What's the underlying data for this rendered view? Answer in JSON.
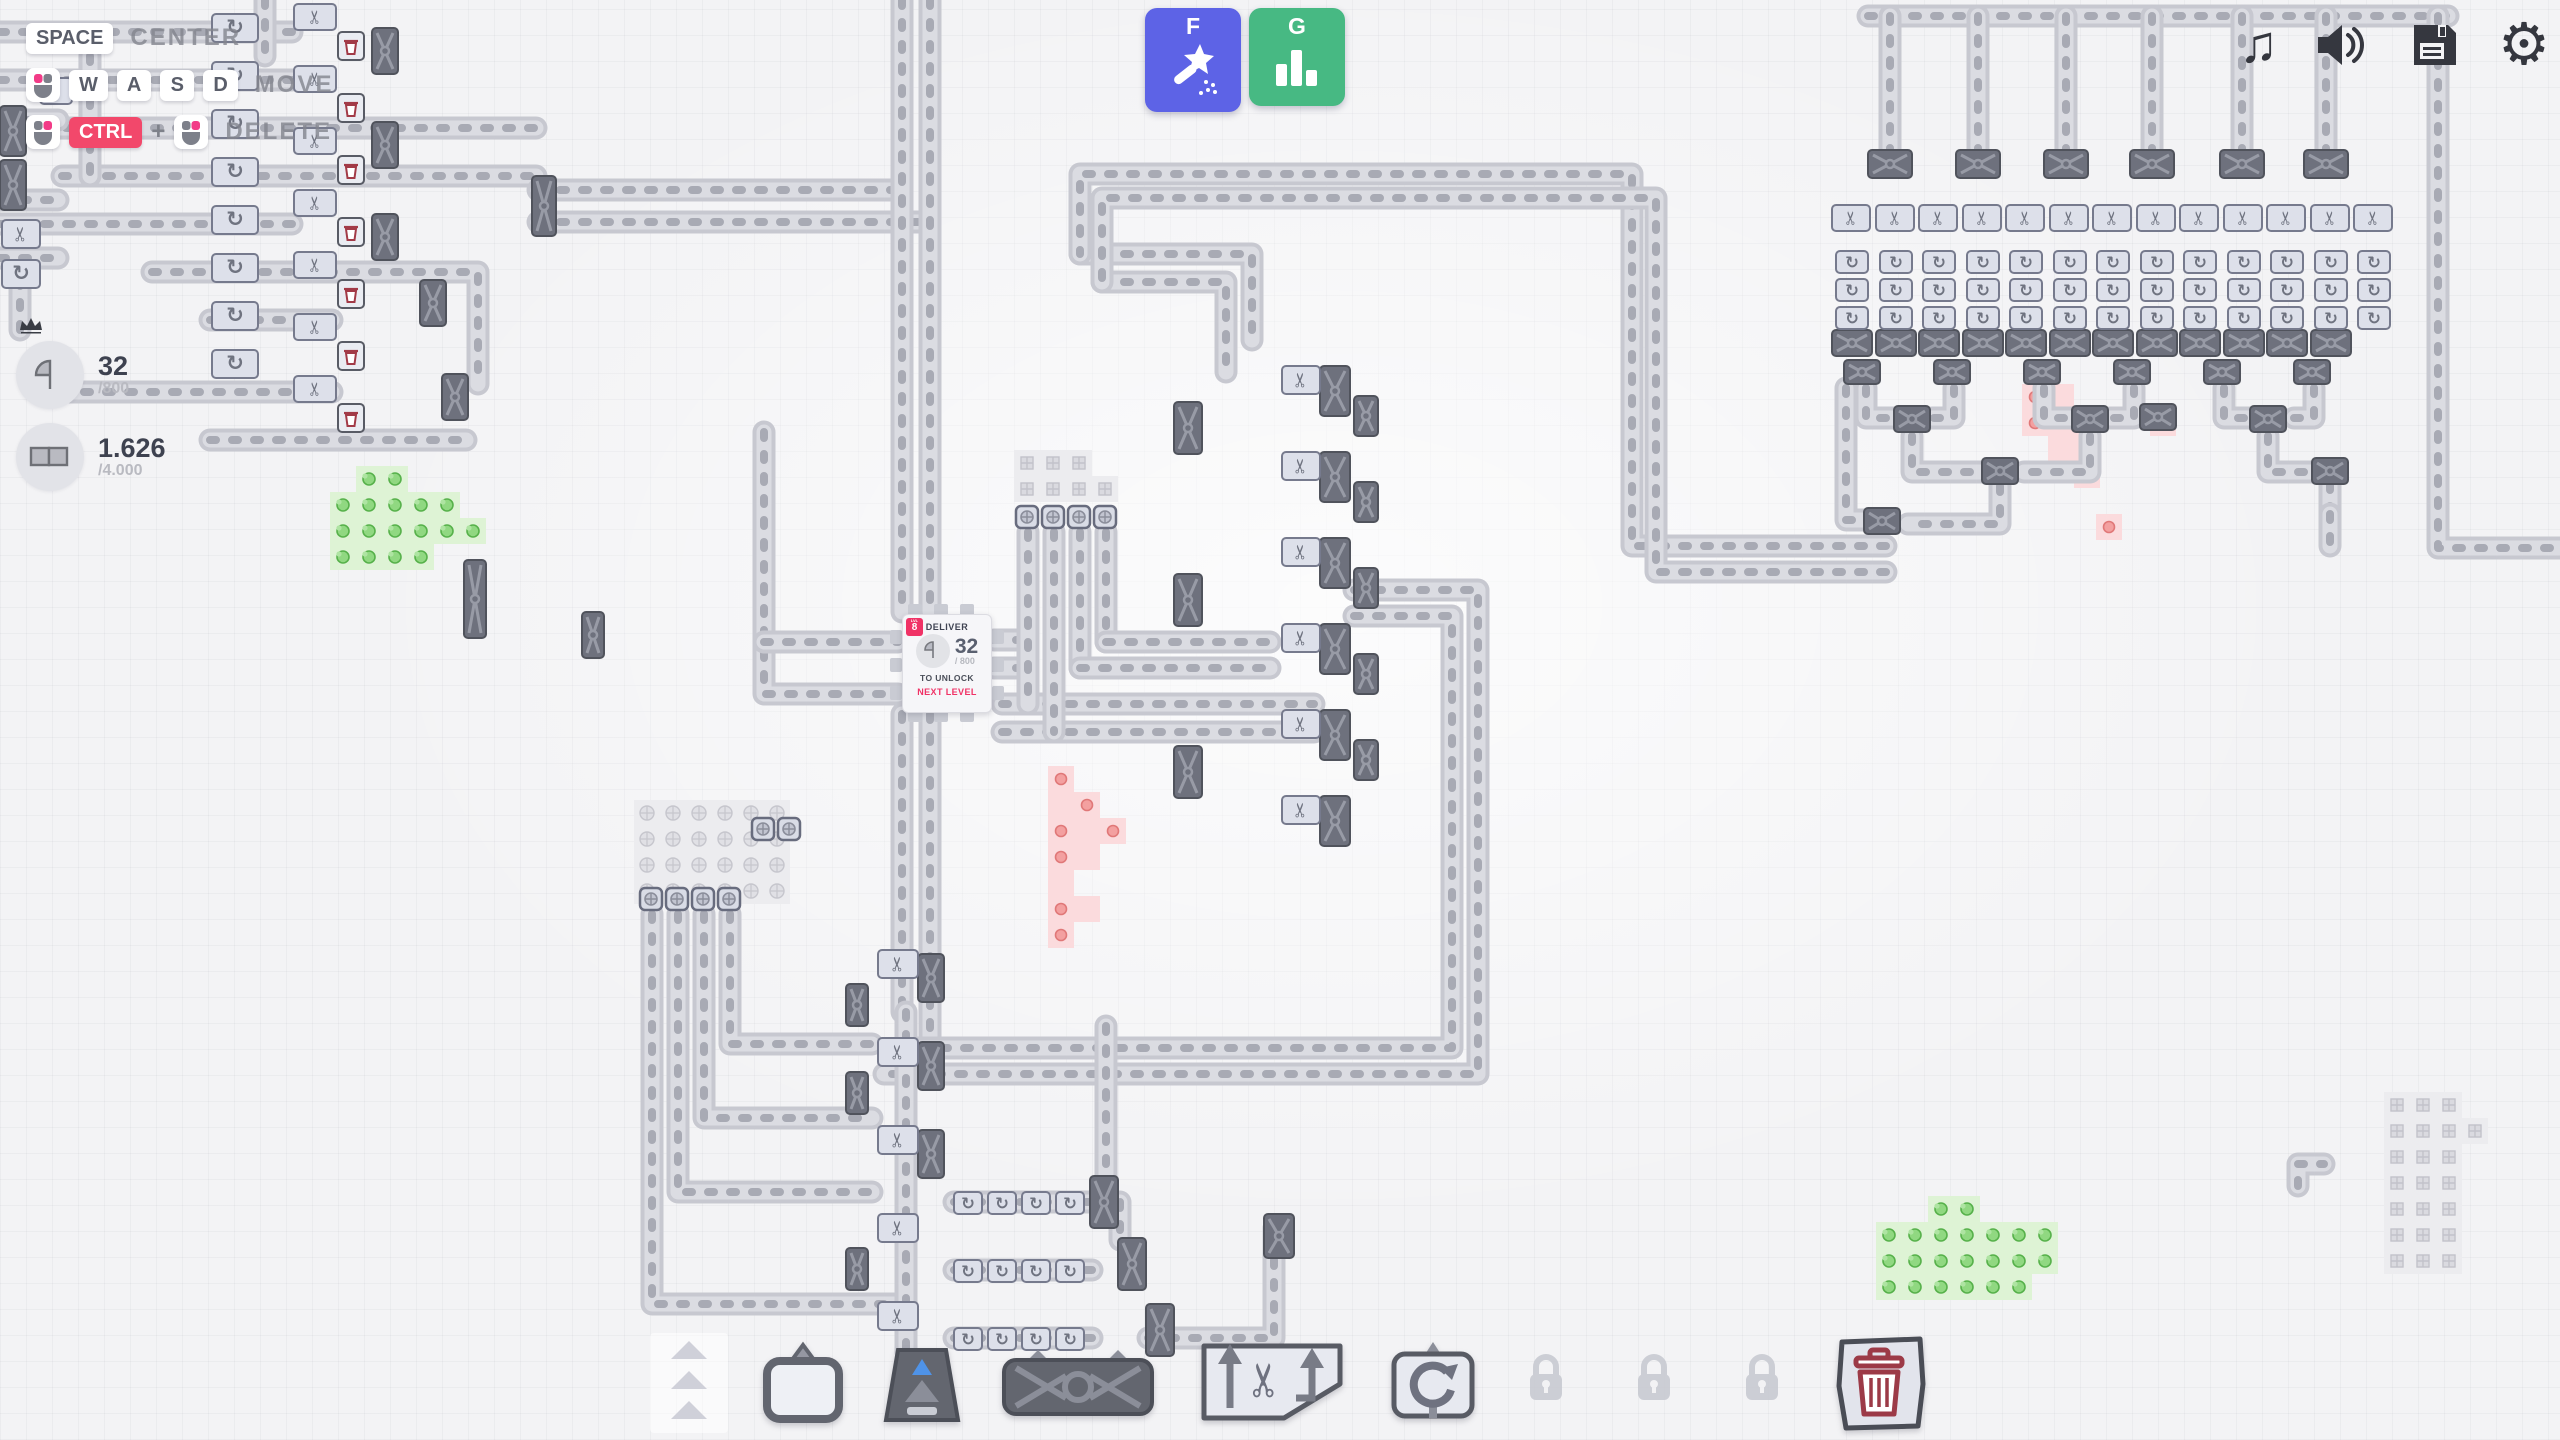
{
  "hud": {
    "hints": {
      "center": {
        "key": "SPACE",
        "action": "CENTER"
      },
      "move": {
        "mouse": "mouse-left-button-icon",
        "keys": [
          "W",
          "A",
          "S",
          "D"
        ],
        "action": "MOVE"
      },
      "delete": {
        "mouse_a": "mouse-right-button-icon",
        "key": "CTRL",
        "plus": "+",
        "mouse_b": "mouse-right-button-icon",
        "action": "DELETE"
      }
    },
    "goals": {
      "level": {
        "shape": "quarter-circle",
        "value": "32",
        "target": "/800"
      },
      "upgrade": {
        "shape": "double-rectangle",
        "value": "1.626",
        "target": "/4.000"
      }
    },
    "quick_access": [
      {
        "hotkey": "F",
        "icon": "magic-wand-icon",
        "color": "#5d63e6"
      },
      {
        "hotkey": "G",
        "icon": "bar-chart-icon",
        "color": "#47b983"
      }
    ],
    "system_menu": [
      {
        "icon": "music-note-icon"
      },
      {
        "icon": "speaker-icon"
      },
      {
        "icon": "save-icon"
      },
      {
        "icon": "settings-gear-icon"
      }
    ]
  },
  "hub": {
    "level_tag": "LVL",
    "level_number": "8",
    "title": "DELIVER",
    "shape": "quarter-circle",
    "value": "32",
    "target": "/ 800",
    "subtitle1": "TO UNLOCK",
    "subtitle2": "NEXT LEVEL"
  },
  "toolbar": {
    "items": [
      {
        "name": "belt",
        "locked": false
      },
      {
        "name": "extractor",
        "locked": false
      },
      {
        "name": "tunnel",
        "locked": false
      },
      {
        "name": "balancer",
        "locked": false
      },
      {
        "name": "cutter",
        "locked": false
      },
      {
        "name": "rotator",
        "locked": false
      },
      {
        "name": "locked-slot-1",
        "locked": true
      },
      {
        "name": "locked-slot-2",
        "locked": true
      },
      {
        "name": "locked-slot-3",
        "locked": true
      },
      {
        "name": "trash",
        "locked": false
      }
    ]
  },
  "colors": {
    "accent_blue": "#5d63e6",
    "accent_green": "#47b983",
    "accent_red": "#f2486b",
    "hub_badge": "#f03266",
    "trash_glyph": "#9c3a47",
    "map_background": "#f3f3f5",
    "belt": "#c7c8d0",
    "machine_dark": "#6e717d",
    "machine_light": "#dde0ea",
    "patch_green": "#def3d5",
    "patch_red": "#fbdbdd"
  }
}
